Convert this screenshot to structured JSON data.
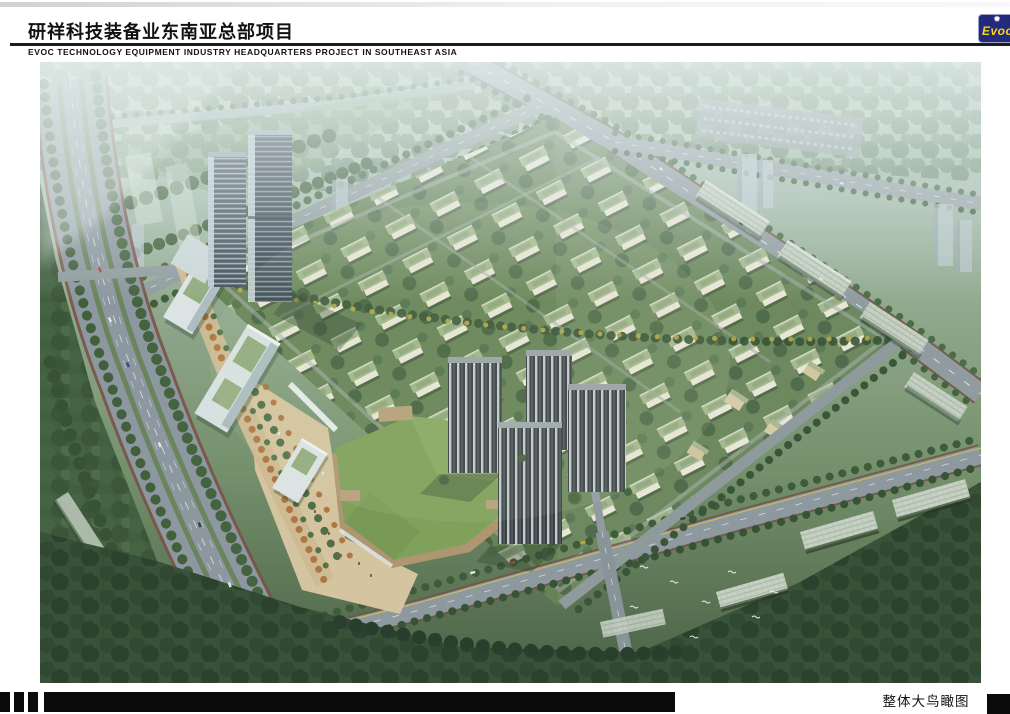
{
  "header": {
    "title_cn": "研祥科技装备业东南亚总部项目",
    "title_en": "EVOC TECHNOLOGY EQUIPMENT INDUSTRY HEADQUARTERS PROJECT IN SOUTHEAST ASIA",
    "logo_text": "Evoc",
    "logo_colors": {
      "background": "#232a7c",
      "text": "#f5d416",
      "burst": "#ffffff"
    }
  },
  "footer": {
    "caption": "整体大鸟瞰图"
  },
  "scene_palette": {
    "sky_haze": "#b5cbc7",
    "distant_green": "#93ab91",
    "mid_green": "#6d8a63",
    "dark_green": "#2c4729",
    "road_grey": "#8a949b",
    "road_edge_maroon": "#6e463c",
    "villa_roof_sage": "#9db183",
    "villa_wall": "#e9e6d4",
    "office_tower_glass": "#3a4652",
    "residential_tower": "#2f353a",
    "mall_lawn_roof": "#7a9c52",
    "plaza_tan": "#d4c29a"
  }
}
